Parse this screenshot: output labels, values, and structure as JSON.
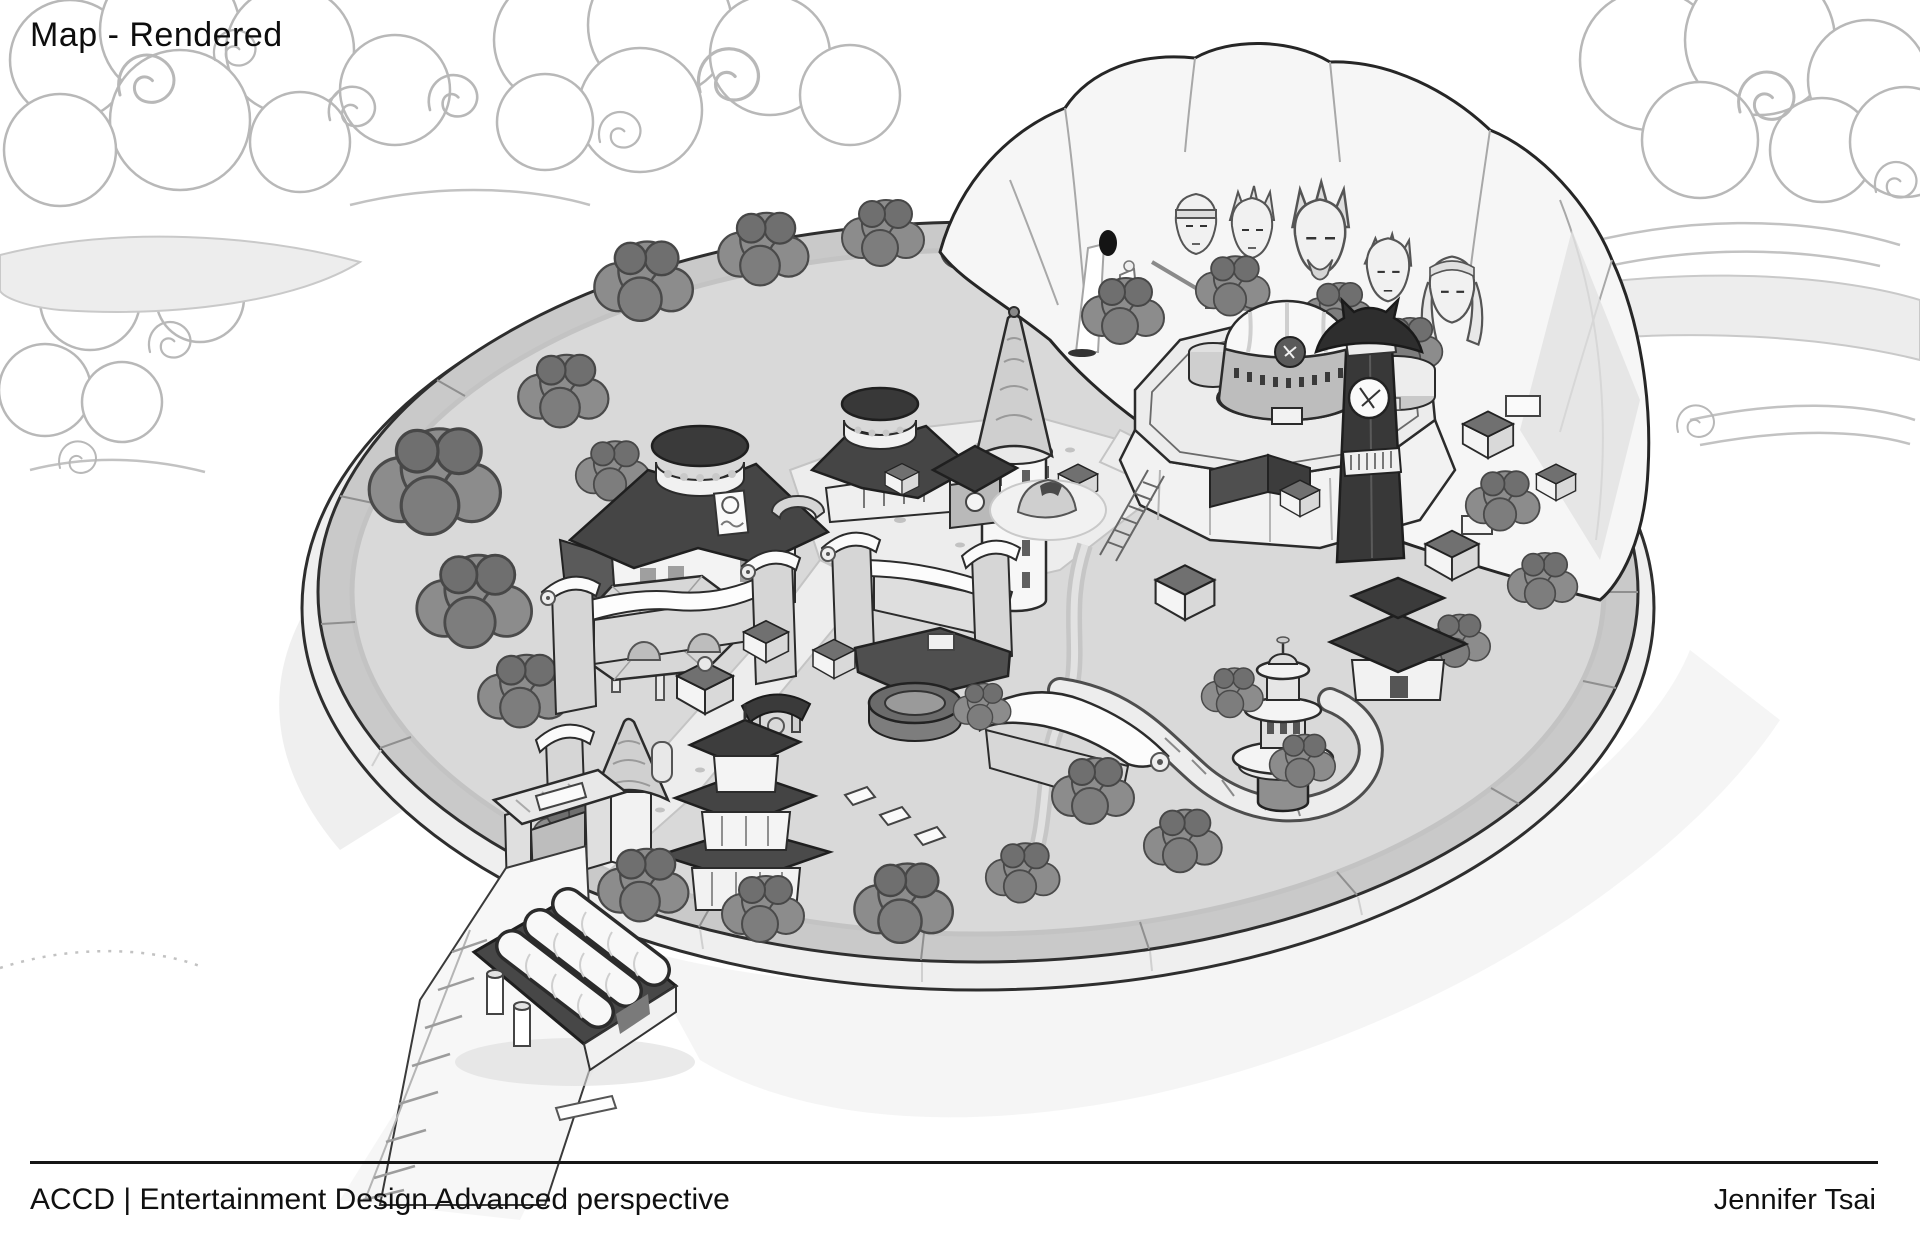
{
  "page": {
    "title": "Map - Rendered"
  },
  "footer": {
    "course": "ACCD | Entertainment Design Advanced perspective",
    "artist": "Jennifer Tsai"
  },
  "palette": {
    "paper": "#ffffff",
    "ink": "#2b2b2b",
    "cloud_line": "#b8b8b8",
    "cloud_shade": "#ededed",
    "wall_top": "#c9c9c9",
    "village_ground": "#d9d9d9",
    "plaza": "#eeeeee",
    "tree": "#8c8c8c",
    "tree_dark": "#6f6f6f",
    "roof_dark": "#3f3f3f",
    "white_roof": "#f8f8f8",
    "mountain": "#f6f6f6"
  },
  "map": {
    "landmarks": [
      "circular walled village seen in aerial perspective",
      "carved cliff monument with five faces",
      "waterfall cave with robed statue",
      "domed administration tower on raised plateau",
      "round drum-roof hall with signboard",
      "second drum-roof hall",
      "white watchtower with conical roof",
      "dark clock tower with emblem",
      "hexagonal pavilion",
      "curled-roof training walls and gates",
      "three-tier pagoda",
      "stone cone hut",
      "circular arena",
      "tiered round tower by winding road",
      "main gate in outer wall",
      "supply depot with barrel roofs outside the gate",
      "hatched railway road leaving the village",
      "swirling stylized clouds"
    ]
  }
}
